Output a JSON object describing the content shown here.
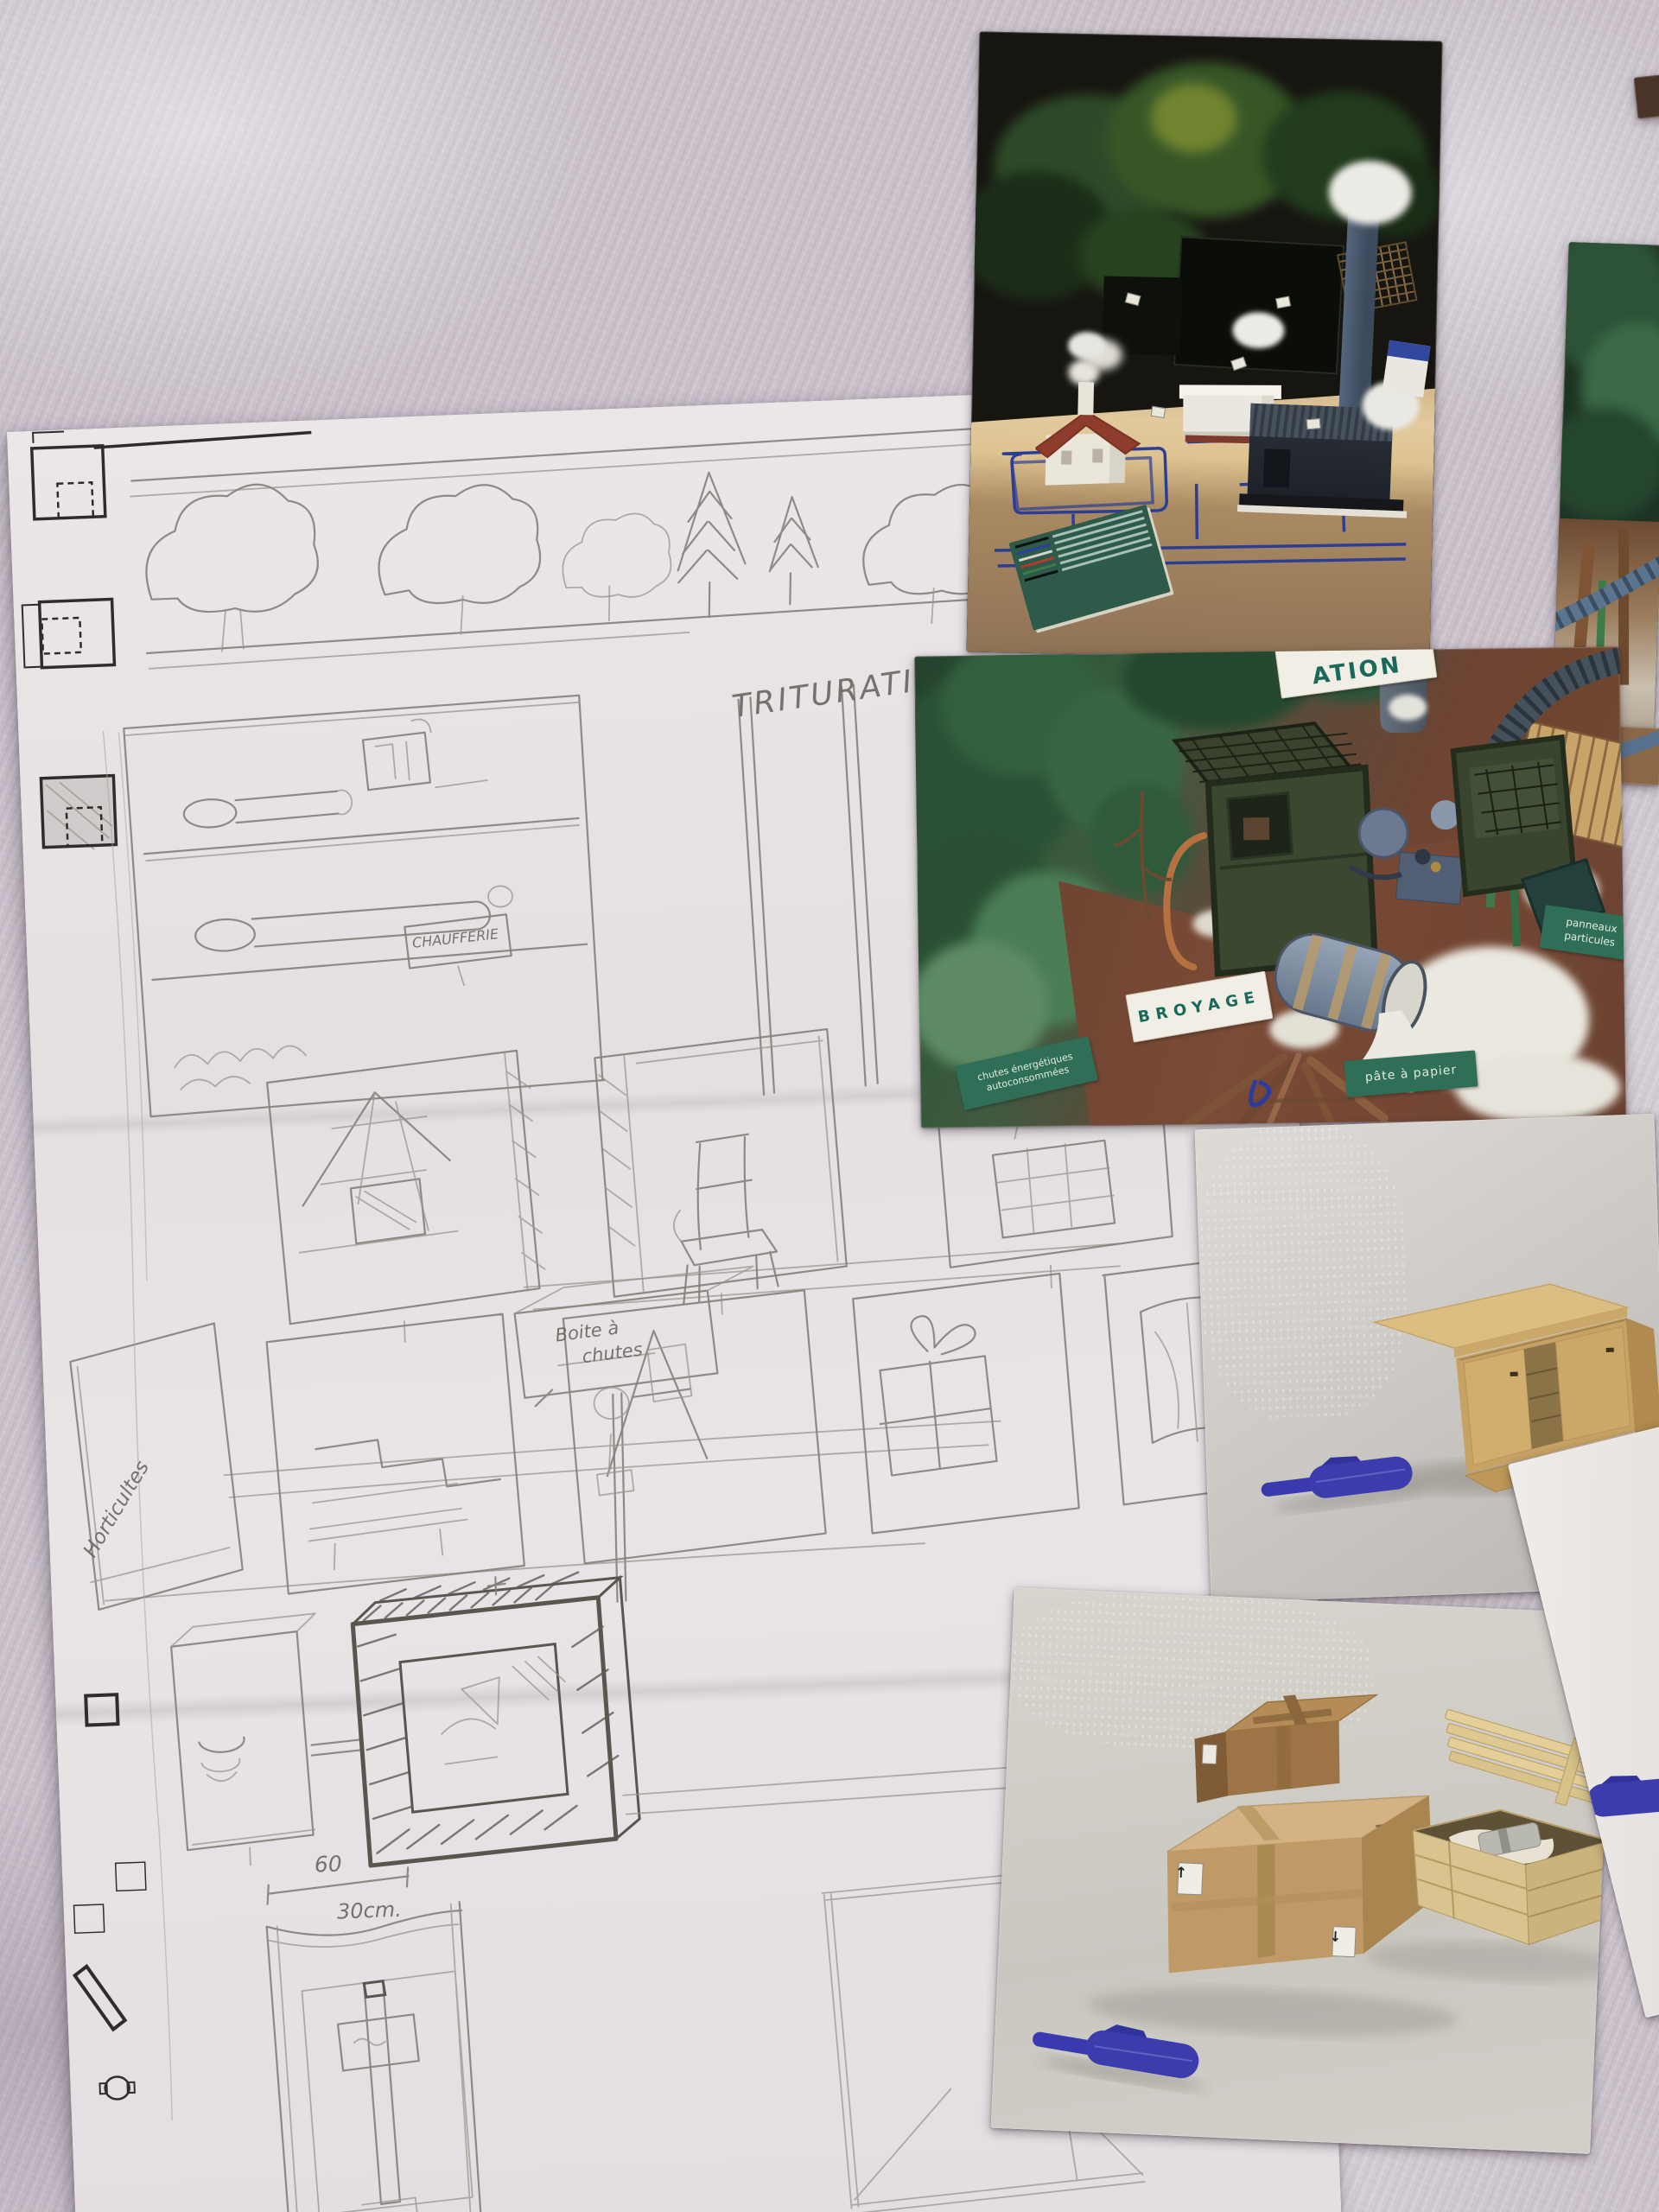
{
  "scene": {
    "subject": "pencil storyboard sketch of an exhibition display on paper, with photo prints of a miniature wood-industry diorama and miniature furniture models, lying on lilac fabric"
  },
  "colors": {
    "fabric": "#c8bfc9",
    "paper": "#e8e3e5",
    "pencil": "#85807a",
    "printed_ink": "#2f2d2b",
    "pen_blue": "#3a3aae",
    "sign_green": "#2f6e57",
    "sign_text_teal": "#19695a",
    "wood_tan": "#c7a265",
    "cardboard": "#bf9963",
    "diorama_green": "#3a6b4c",
    "pipe_blue": "#2c3e94"
  },
  "sketch": {
    "labels": {
      "trituration": "TRITURATION",
      "chaufferie": "CHAUFFERIE",
      "boite_line1": "Boite à",
      "boite_line2": "chutes",
      "horticoles": "Horticultes",
      "letter_b": "B",
      "letter_d": "D",
      "dim_width": "60",
      "dim_depth": "30cm."
    }
  },
  "photos": {
    "broyage": {
      "sign_broyage": "BROYAGE",
      "sign_trituration_partial": "ATION",
      "sign_chutes_line1": "chutes énergétiques",
      "sign_chutes_line2": "autoconsommées",
      "sign_pate": "pâte à papier",
      "sign_panneaux_line1": "panneaux",
      "sign_panneaux_line2": "particules"
    },
    "boxes": {
      "icons": {
        "up_arrow": "↑",
        "down_arrow": "↓"
      }
    }
  }
}
